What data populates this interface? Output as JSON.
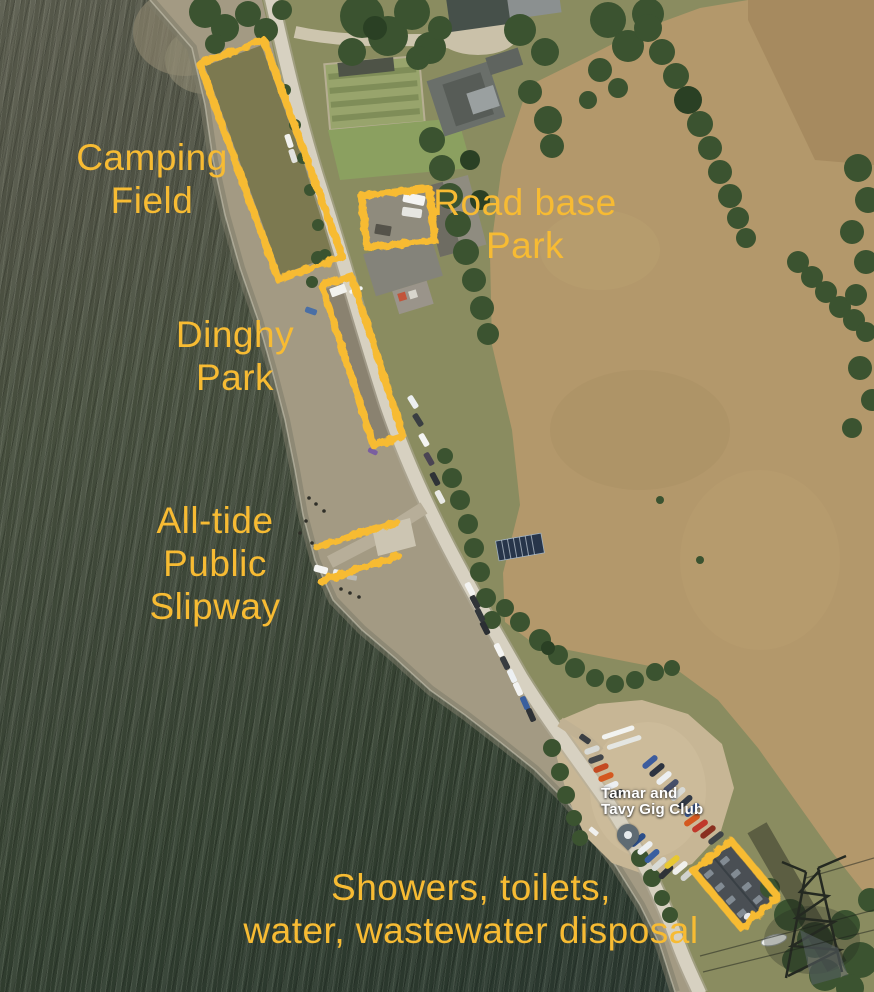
{
  "map": {
    "annotation_color": "#F7BB33",
    "poi_label": {
      "line1": "Tamar and",
      "line2": "Tavy Gig Club"
    },
    "annotations": {
      "camping_field": {
        "line1": "Camping",
        "line2": "Field"
      },
      "road_base_park": {
        "line1": "Road base",
        "line2": "Park"
      },
      "dinghy_park": {
        "line1": "Dinghy",
        "line2": "Park"
      },
      "all_tide_slipway": {
        "line1": "All-tide",
        "line2": "Public",
        "line3": "Slipway"
      },
      "showers": {
        "line1": "Showers, toilets,",
        "line2": "water, wastewater disposal"
      }
    }
  }
}
